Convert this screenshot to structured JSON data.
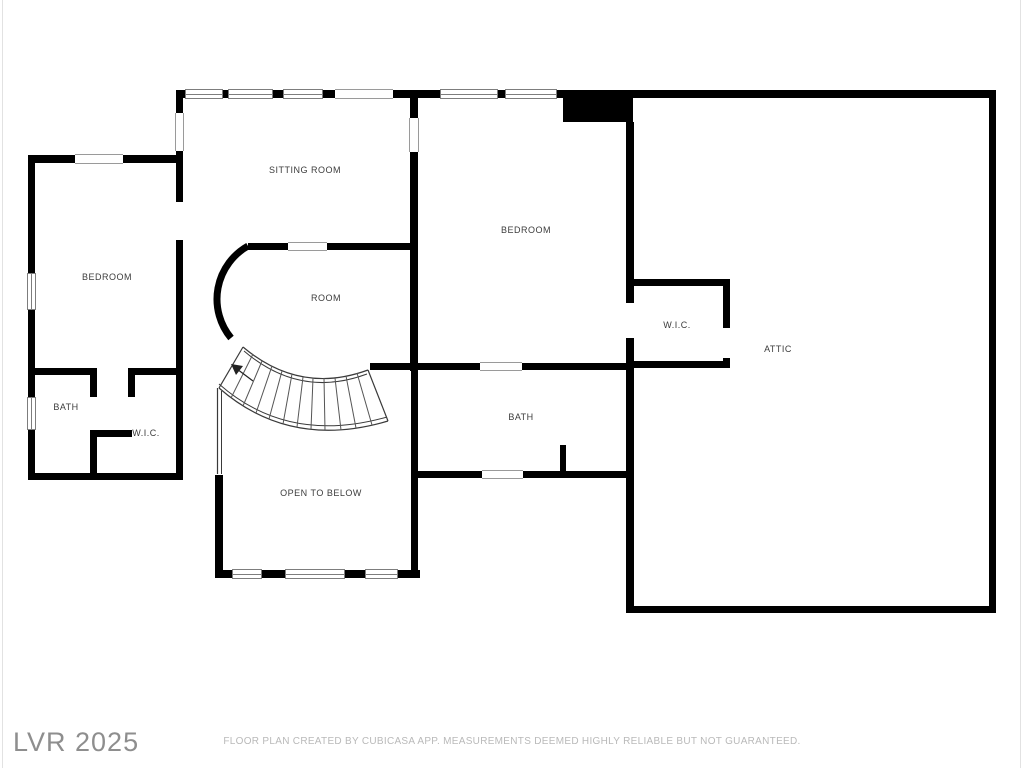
{
  "rooms": {
    "sitting_room": {
      "label": "SITTING ROOM"
    },
    "bedroom_left": {
      "label": "BEDROOM"
    },
    "room": {
      "label": "ROOM"
    },
    "bedroom": {
      "label": "BEDROOM"
    },
    "wic_right": {
      "label": "W.I.C."
    },
    "attic": {
      "label": "ATTIC"
    },
    "bath_left": {
      "label": "BATH"
    },
    "wic_left": {
      "label": "W.I.C."
    },
    "bath": {
      "label": "BATH"
    },
    "open_to_below": {
      "label": "OPEN TO BELOW"
    }
  },
  "footer": {
    "disclaimer": "FLOOR PLAN CREATED BY CUBICASA APP. MEASUREMENTS DEEMED HIGHLY RELIABLE BUT NOT GUARANTEED.",
    "watermark": "LVR 2025"
  },
  "colors": {
    "wall": "#000000",
    "room_label": "#3c3c3c",
    "window_frame": "#7d7d7d",
    "disclaimer_text": "#b9b9b9",
    "watermark_text": "#8e8e8e"
  }
}
